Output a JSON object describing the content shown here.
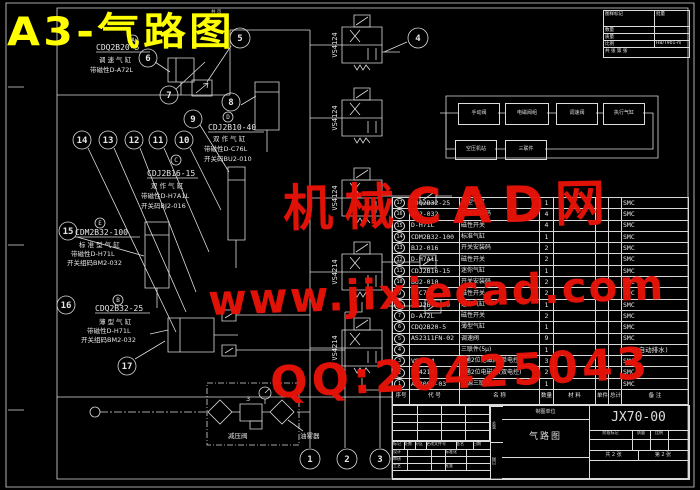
{
  "title": "A3-气路图",
  "top_note": "共 页",
  "colors": {
    "background": "#000000",
    "line": "#dcdcdc",
    "title": "#ffff00",
    "watermark": "#ea1208"
  },
  "watermark": {
    "line1": "机械CAD网",
    "line2": "www.jixiecad.com",
    "line3": "QQ:20425043"
  },
  "corner_table": {
    "rows": [
      {
        "label": "图样标记",
        "value": "批量"
      },
      {
        "label": "数量",
        "value": ""
      },
      {
        "label": "质量",
        "value": ""
      },
      {
        "label": "比例",
        "value": "HB/T901-m"
      }
    ],
    "footer": "共 张 第 张"
  },
  "flow": {
    "boxes_row1": [
      "手动阀",
      "电磁阀组",
      "调速阀",
      "执行气缸"
    ],
    "boxes_row2": [
      "空压机站",
      "三联件"
    ]
  },
  "valves": [
    {
      "label": "VS4124"
    },
    {
      "label": "VS4124"
    },
    {
      "label": "VS4124"
    },
    {
      "label": "VS4214"
    },
    {
      "label": "VS4214"
    }
  ],
  "annotations": [
    {
      "tag": "A",
      "code": "CDQ2B20-5",
      "kind": "调 速 气 缸",
      "sw": "带磁性D-A72L",
      "acc": ""
    },
    {
      "tag": "D",
      "code": "CDJ2B10-40",
      "kind": "双 作 气 缸",
      "sw": "带磁性D-C76L",
      "acc": "开关码BU2-010"
    },
    {
      "tag": "C",
      "code": "CDJ2B16-15",
      "kind": "双 作 气 缸",
      "sw": "带磁性D-H7A1L",
      "acc": "开关码BJ2-016"
    },
    {
      "tag": "E",
      "code": "CDM2B32-100",
      "kind": "标 准 型 气 缸",
      "sw": "带磁性D-H71L",
      "acc": "开关组码BM2-032"
    },
    {
      "tag": "B",
      "code": "CDQ2B32-25",
      "kind": "薄 型 气 缸",
      "sw": "带磁性D-H71L",
      "acc": "开关组码BM2-032"
    }
  ],
  "frl": {
    "label_left": "减压阀",
    "label_right": "油雾器",
    "num": "3"
  },
  "balloons": [
    "1",
    "2",
    "3",
    "4",
    "5",
    "6",
    "7",
    "8",
    "9",
    "10",
    "11",
    "12",
    "13",
    "14",
    "15",
    "16",
    "17"
  ],
  "parts": {
    "header": {
      "no": "序号",
      "code": "代 号",
      "name": "名 称",
      "qty": "数量",
      "material": "材 料",
      "w1": "单件",
      "w2": "总计",
      "remark": "备 注"
    },
    "rows": [
      {
        "no": "17",
        "code": "CDQ2B32-25",
        "name": "薄型气缸",
        "qty": "1",
        "vendor": "SMC"
      },
      {
        "no": "16",
        "code": "BM2-032",
        "name": "开关安装码",
        "qty": "4",
        "vendor": "SMC"
      },
      {
        "no": "15",
        "code": "D-H71L",
        "name": "磁性开关",
        "qty": "4",
        "vendor": "SMC"
      },
      {
        "no": "14",
        "code": "CDM2B32-100",
        "name": "标准气缸",
        "qty": "1",
        "vendor": "SMC"
      },
      {
        "no": "13",
        "code": "BJ2-016",
        "name": "开关安装码",
        "qty": "2",
        "vendor": "SMC"
      },
      {
        "no": "12",
        "code": "D-H7A1L",
        "name": "磁性开关",
        "qty": "2",
        "vendor": "SMC"
      },
      {
        "no": "11",
        "code": "CDJ2B16-15",
        "name": "迷你气缸",
        "qty": "1",
        "vendor": "SMC"
      },
      {
        "no": "10",
        "code": "BU2-010",
        "name": "开关安装码",
        "qty": "2",
        "vendor": "SMC"
      },
      {
        "no": "9",
        "code": "D-C76L",
        "name": "磁性开关",
        "qty": "2",
        "vendor": "SMC"
      },
      {
        "no": "8",
        "code": "CDJ2B10-40",
        "name": "迷你气缸",
        "qty": "1",
        "vendor": "SMC"
      },
      {
        "no": "7",
        "code": "D-A72L",
        "name": "磁性开关",
        "qty": "2",
        "vendor": "SMC"
      },
      {
        "no": "6",
        "code": "CDQ2B20-5",
        "name": "薄型气缸",
        "qty": "1",
        "vendor": "SMC"
      },
      {
        "no": "5",
        "code": "AS2311FN-02",
        "name": "调速阀",
        "qty": "9",
        "vendor": "SMC"
      },
      {
        "no": "4",
        "code": "",
        "name": "三联件(5μ)",
        "qty": "1",
        "vendor": "SMC(自动排水)"
      },
      {
        "no": "3",
        "code": "VS4124",
        "name": "5通2位电磁阀(单电控)",
        "qty": "3",
        "vendor": "SMC"
      },
      {
        "no": "2",
        "code": "VS4214",
        "name": "5通2位电磁阀(双电控)",
        "qty": "2",
        "vendor": "SMC"
      },
      {
        "no": "1",
        "code": "AC3000-03",
        "name": "气源三联件",
        "qty": "1",
        "vendor": "SMC"
      }
    ]
  },
  "titleblock": {
    "drawing_no": "JX70-00",
    "drawing_title": "气路图",
    "company": "制图单位",
    "rev_labels": [
      "标记",
      "处数",
      "分区",
      "更改文件号",
      "签名",
      "日期"
    ],
    "sign_left": [
      "设计",
      "审核",
      "工艺",
      "批准"
    ],
    "sign_mid": [
      "标准化",
      "",
      "",
      ""
    ],
    "stage": [
      "阶段标记",
      "质量",
      "比例"
    ],
    "sheet_total": "共 2 张",
    "sheet_no": "第 2 张",
    "strip_top": "签字",
    "strip_bottom": "日期"
  }
}
